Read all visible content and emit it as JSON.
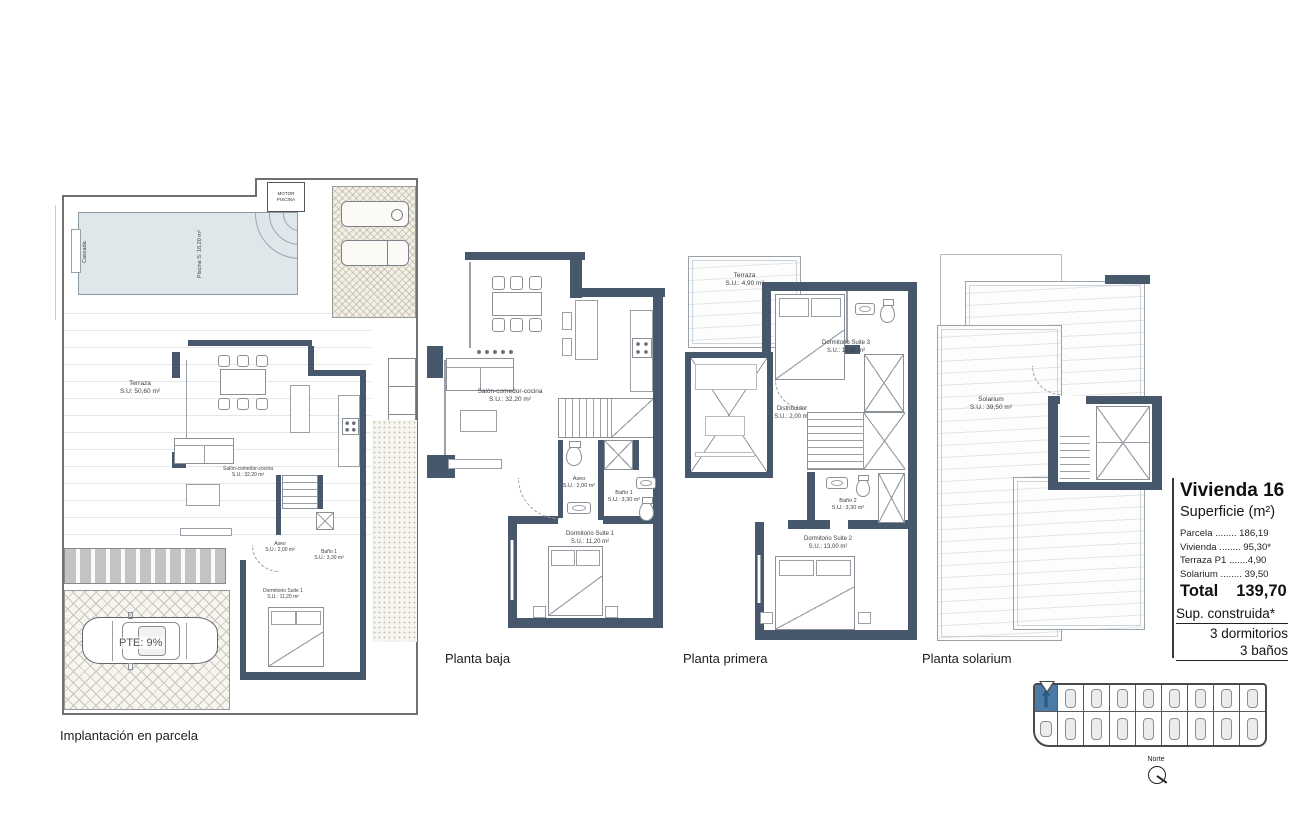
{
  "colors": {
    "wall": "#47586c",
    "pool": "#e0e7ea",
    "highlight_blue": "#4a7ca6"
  },
  "site": {
    "caption": "Implantación en parcela",
    "cascada": "Cascada",
    "motor_line1": "MOTOR",
    "motor_line2": "PISCINA",
    "piscina": {
      "name": "Piscina",
      "area": "S: 18,20 m²"
    },
    "terraza": {
      "name": "Terraza",
      "area": "S.U: 50,60 m²"
    },
    "pte": "PTE: 9%",
    "rooms": {
      "salon": {
        "name": "Salón-comedor-cocina",
        "area": "S.U.: 32,20 m²"
      },
      "aseo": {
        "name": "Aseo",
        "area": "S.U.: 2,00 m²"
      },
      "bano1": {
        "name": "Baño 1",
        "area": "S.U.: 3,30 m²"
      },
      "suite1": {
        "name": "Dormitorio Suite 1",
        "area": "S.U.: 11,20 m²"
      }
    }
  },
  "pb": {
    "caption": "Planta baja",
    "rooms": {
      "salon": {
        "name": "Salón-comedor-cocina",
        "area": "S.U.: 32,20 m²"
      },
      "aseo": {
        "name": "Aseo",
        "area": "S.U.: 2,00 m²"
      },
      "bano1": {
        "name": "Baño 1",
        "area": "S.U.: 3,30 m²"
      },
      "suite1": {
        "name": "Dormitorio Suite 1",
        "area": "S.U.: 11,20 m²"
      }
    }
  },
  "pp": {
    "caption": "Planta primera",
    "rooms": {
      "terraza": {
        "name": "Terraza",
        "area": "S.U.: 4,90 m²"
      },
      "suite3": {
        "name": "Dormitorio Suite 3",
        "area": "S.U.: 11,80 m²"
      },
      "distribuidor": {
        "name": "Distribuidor",
        "area": "S.U.: 2,00 m²"
      },
      "bano2": {
        "name": "Baño 2",
        "area": "S.U.: 3,30 m²"
      },
      "suite2": {
        "name": "Dormitorio Suite 2",
        "area": "S.U.: 13,00 m²"
      }
    }
  },
  "ps": {
    "caption": "Planta solarium",
    "rooms": {
      "solarium": {
        "name": "Solarium",
        "area": "S.U.: 39,50 m²"
      }
    }
  },
  "info": {
    "title": "Vivienda 16",
    "subtitle": "Superficie (m²)",
    "rows": [
      "Parcela ........ 186,19",
      "Vivienda ........ 95,30*",
      "Terraza P1 .......4,90",
      "Solarium ........ 39,50"
    ],
    "total_label": "Total",
    "total_value": "139,70",
    "notes": {
      "built": "Sup. construida*",
      "bedrooms": "3 dormitorios",
      "baths": "3 baños"
    }
  },
  "mini": {
    "north": "Norte"
  }
}
